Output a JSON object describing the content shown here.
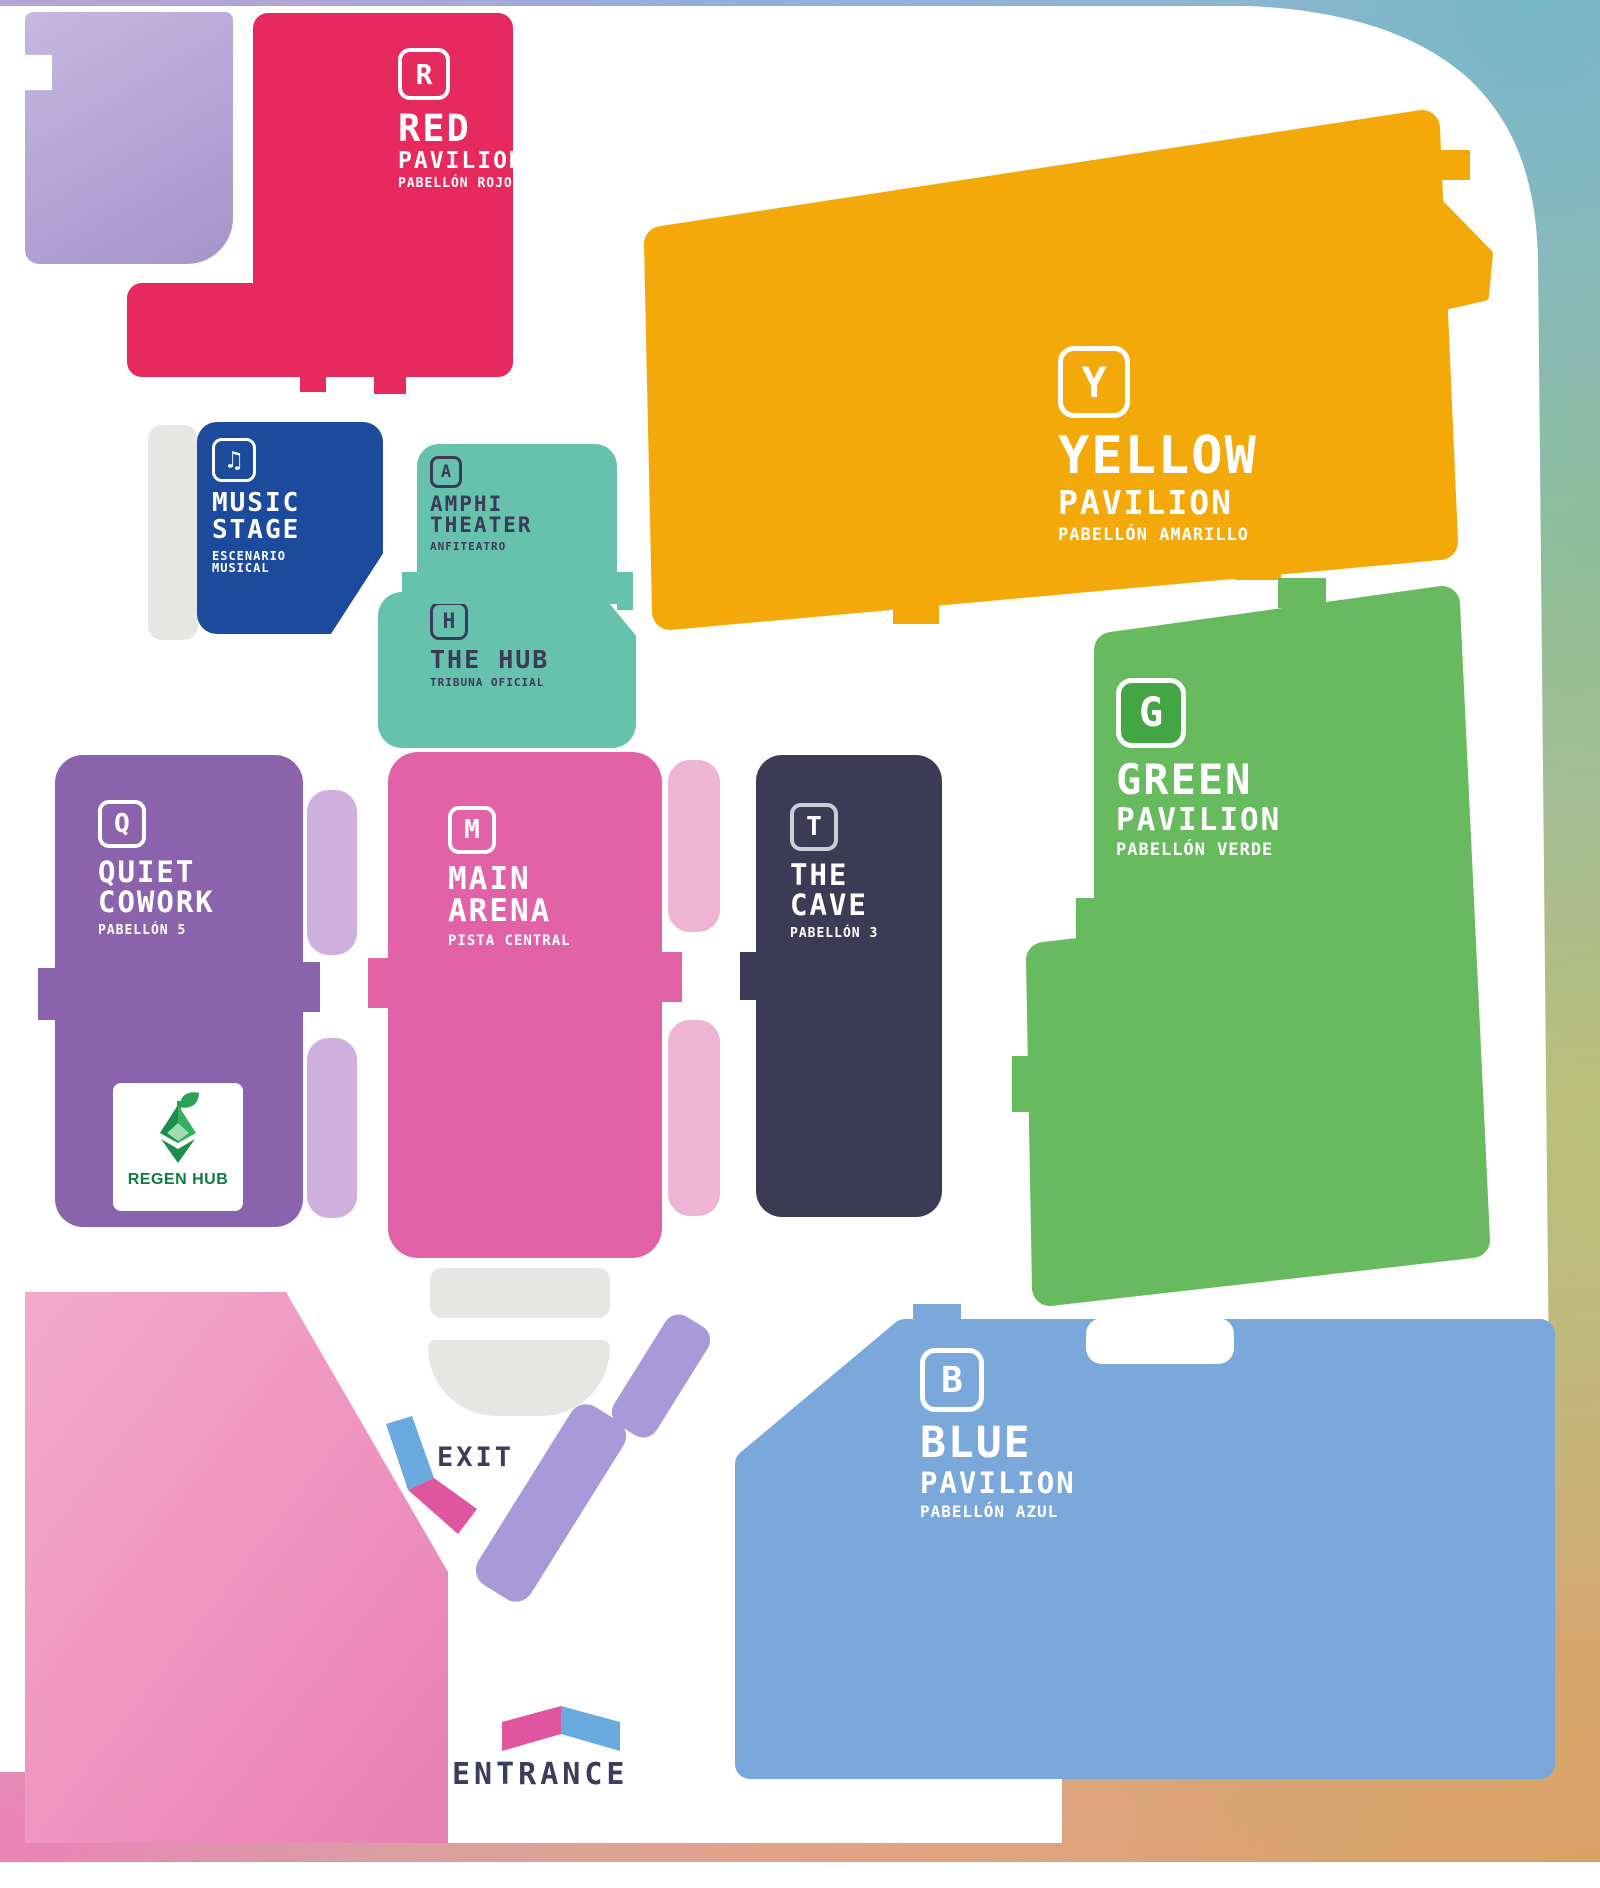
{
  "map": {
    "exit_label": "EXIT",
    "entrance_label": "ENTRANCE"
  },
  "venues": {
    "red": {
      "letter": "R",
      "name": "RED",
      "type": "PAVILION",
      "subtitle": "PABELLÓN ROJO"
    },
    "yellow": {
      "letter": "Y",
      "name": "YELLOW",
      "type": "PAVILION",
      "subtitle": "PABELLÓN AMARILLO"
    },
    "green": {
      "letter": "G",
      "name": "GREEN",
      "type": "PAVILION",
      "subtitle": "PABELLÓN VERDE"
    },
    "blue": {
      "letter": "B",
      "name": "BLUE",
      "type": "PAVILION",
      "subtitle": "PABELLÓN AZUL"
    },
    "music_stage": {
      "icon": "♫",
      "line1": "MUSIC",
      "line2": "STAGE",
      "sub1": "ESCENARIO",
      "sub2": "MUSICAL"
    },
    "amphitheater": {
      "letter": "A",
      "line1": "AMPHI",
      "line2": "THEATER",
      "subtitle": "ANFITEATRO"
    },
    "the_hub": {
      "letter": "H",
      "name": "THE HUB",
      "subtitle": "TRIBUNA OFICIAL"
    },
    "quiet_cowork": {
      "letter": "Q",
      "line1": "QUIET",
      "line2": "COWORK",
      "subtitle": "PABELLÓN 5"
    },
    "main_arena": {
      "letter": "M",
      "line1": "MAIN",
      "line2": "ARENA",
      "subtitle": "PISTA CENTRAL"
    },
    "the_cave": {
      "letter": "T",
      "line1": "THE",
      "line2": "CAVE",
      "subtitle": "PABELLÓN 3"
    }
  },
  "regen_hub": {
    "label": "REGEN HUB"
  },
  "colors": {
    "red": "#e72a5d",
    "yellow": "#f3a90a",
    "green": "#68ba5e",
    "blue": "#7ba8db",
    "music_blue": "#1c4b9d",
    "teal": "#66c1ad",
    "purple": "#8a63ac",
    "arena_pink": "#e262a8",
    "cave_navy": "#3c3a55",
    "label_navy": "#3c3c5c",
    "exit_blue": "#6aaade",
    "exit_pink": "#df55a0",
    "walkway_lavender": "#a89ad8",
    "connector_lilac": "#cfb0dc",
    "connector_pink": "#edb4d4",
    "service_gray": "#e6e6e4",
    "regen_green": "#0e7c3f",
    "wedge_pink": "#ee8fba",
    "reveal_lavender": "#b7a5d6"
  }
}
